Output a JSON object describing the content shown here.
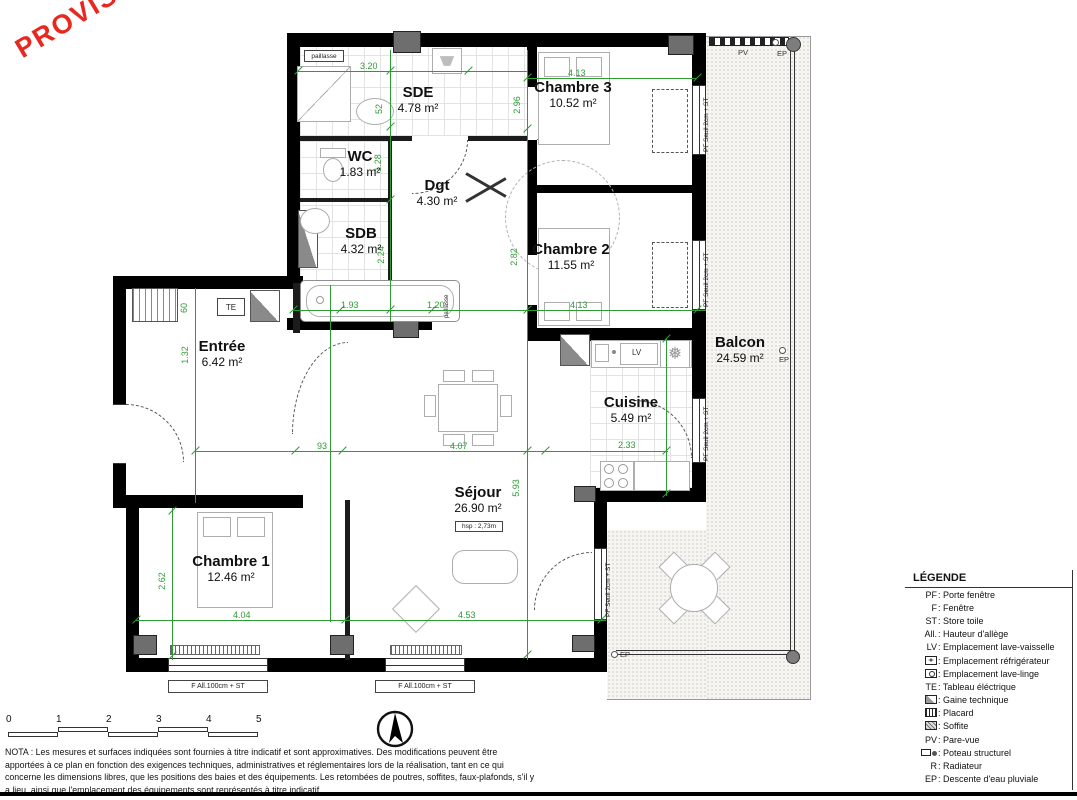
{
  "stamp": {
    "text": "PROVISOIRE",
    "color": "#e8271f"
  },
  "rooms": [
    {
      "name": "SDE",
      "area": "4.78 m²"
    },
    {
      "name": "Chambre 3",
      "area": "10.52 m²"
    },
    {
      "name": "WC",
      "area": "1.83 m²"
    },
    {
      "name": "Dgt",
      "area": "4.30 m²"
    },
    {
      "name": "SDB",
      "area": "4.32 m²"
    },
    {
      "name": "Chambre 2",
      "area": "11.55 m²"
    },
    {
      "name": "Entrée",
      "area": "6.42 m²"
    },
    {
      "name": "Balcon",
      "area": "24.59 m²"
    },
    {
      "name": "Cuisine",
      "area": "5.49 m²"
    },
    {
      "name": "Séjour",
      "area": "26.90 m²",
      "hsp": "hsp : 2,73m"
    },
    {
      "name": "Chambre 1",
      "area": "12.46 m²"
    }
  ],
  "dims": {
    "d320": "3.20",
    "d413a": "4.13",
    "d296": "2.96",
    "d52": "52",
    "d128": "1.28",
    "d282": "2.82",
    "d413b": "4.13",
    "d224": "2.24",
    "d193": "1.93",
    "d120": "1.20",
    "d60": "60",
    "d132": "1.32",
    "d93": "93",
    "d407": "4.07",
    "d233": "2.33",
    "d593": "5.93",
    "d262": "2.62",
    "d404": "4.04",
    "d453": "4.53"
  },
  "labels": {
    "paillasse": "paillasse",
    "te": "TE",
    "lv": "LV",
    "pv": "PV",
    "ep": "EP",
    "pf_seuil": "PF Seuil 2cm + ST",
    "f_all": "F All.100cm + ST",
    "hsp": "hsp : 2,73m"
  },
  "legend": {
    "title": "LÉGENDE",
    "items": [
      {
        "abbr": "PF",
        "label": ": Porte fenêtre"
      },
      {
        "abbr": "F",
        "label": ": Fenêtre"
      },
      {
        "abbr": "ST",
        "label": ": Store toile"
      },
      {
        "abbr": "All.",
        "label": ": Hauteur d'allège"
      },
      {
        "abbr": "LV",
        "label": ": Emplacement lave-vaisselle"
      },
      {
        "abbr": "",
        "icon": "fridge",
        "label": ": Emplacement réfrigérateur"
      },
      {
        "abbr": "",
        "icon": "washer",
        "label": ": Emplacement lave-linge"
      },
      {
        "abbr": "TE",
        "label": ": Tableau éléctrique"
      },
      {
        "abbr": "",
        "icon": "gaine",
        "label": ": Gaine technique"
      },
      {
        "abbr": "",
        "icon": "placard",
        "label": ": Placard"
      },
      {
        "abbr": "",
        "icon": "soffite",
        "label": ": Soffite"
      },
      {
        "abbr": "PV",
        "label": ": Pare-vue"
      },
      {
        "abbr": "",
        "icon": "poteau",
        "label": ": Poteau structurel"
      },
      {
        "abbr": "R",
        "label": ": Radiateur"
      },
      {
        "abbr": "EP",
        "label": ": Descente d'eau pluviale"
      }
    ]
  },
  "scalebar": {
    "ticks": [
      "0",
      "1",
      "2",
      "3",
      "4",
      "5"
    ]
  },
  "nota": "NOTA : Les mesures et surfaces indiquées sont fournies à titre indicatif et sont approximatives. Des modifications peuvent être apportées à ce plan en fonction des exigences techniques, administratives et réglementaires lors de la réalisation, tant en ce qui concerne les dimensions libres, que les positions des baies et des équipements. Les retombées de poutres, soffites, faux-plafonds, s'il y a lieu, ainsi que l'emplacement des équipements sont représentés à titre indicatif."
}
